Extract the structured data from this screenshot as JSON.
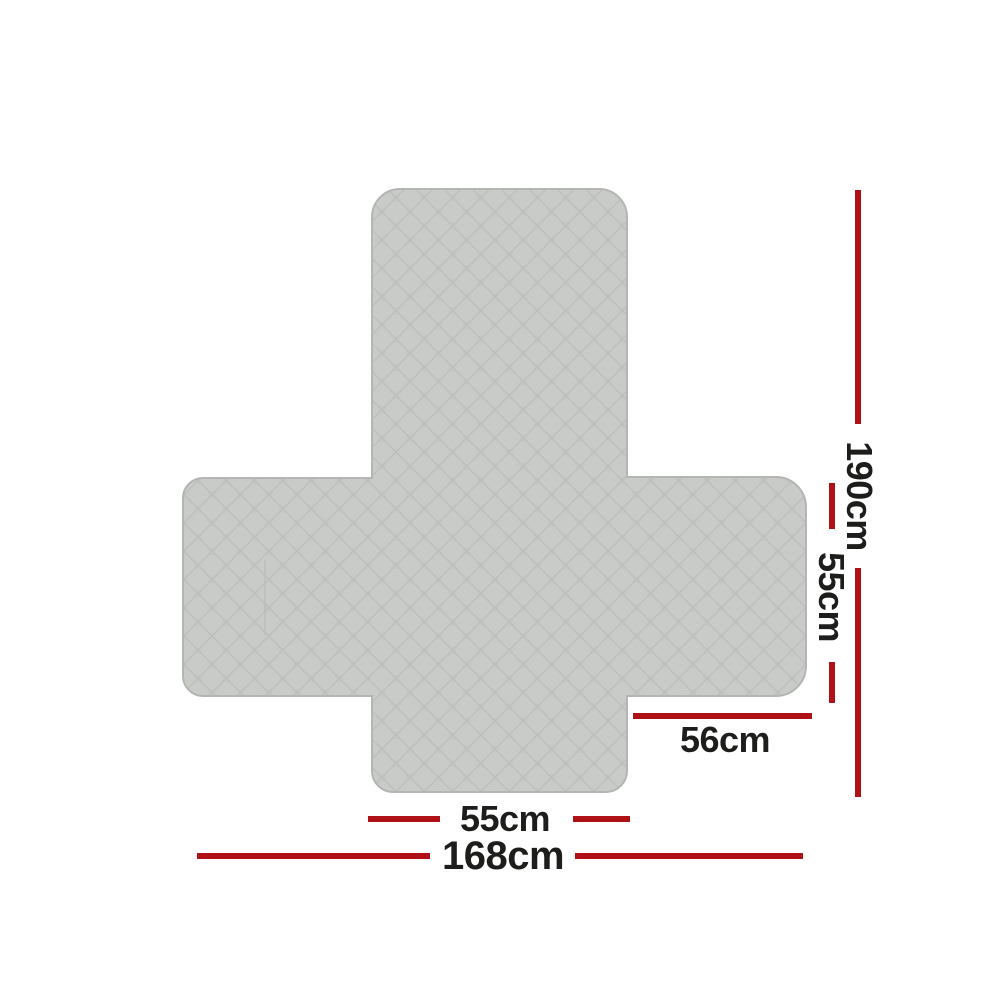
{
  "diagram": {
    "title": "sofa-cover-flat-dimensions",
    "product": "quilted-sofa-cover",
    "dimensions": [
      {
        "measure": "total-length-back-to-front",
        "label": "190cm",
        "orientation": "vertical"
      },
      {
        "measure": "side-arm-depth",
        "label": "55cm",
        "orientation": "vertical"
      },
      {
        "measure": "right-arm-flap-width",
        "label": "56cm",
        "orientation": "horizontal"
      },
      {
        "measure": "seat-front-flap-width",
        "label": "55cm",
        "orientation": "horizontal"
      },
      {
        "measure": "total-width",
        "label": "168cm",
        "orientation": "horizontal"
      }
    ]
  },
  "colors": {
    "background": "#ffffff",
    "accent": "#b01116",
    "text": "#1d1d1b",
    "fabric-base": "#c5c7c4",
    "fabric-cell": "#c9cbc8",
    "fabric-line": "#b8bab7",
    "fabric-edge": "#b4b6b3"
  }
}
